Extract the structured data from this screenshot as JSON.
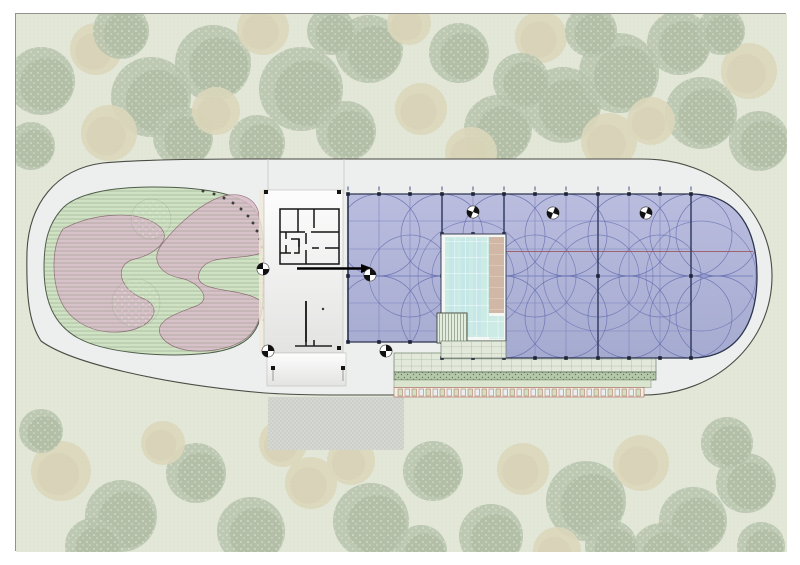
{
  "meta": {
    "kind": "architectural-site-plan",
    "title": ""
  },
  "canvas": {
    "w": 800,
    "h": 565,
    "frame": {
      "x": 15,
      "y": 13,
      "w": 771,
      "h": 538,
      "bg": "#e2e7d8",
      "border": "#92928c"
    }
  },
  "palette": {
    "grass": "#e2e7d8",
    "grass_dot": "#d6dcc7",
    "tree_green": "#8da081",
    "tree_green_dark": "#798e6d",
    "tree_leaf": "#eef2e2",
    "tree_tan": "#d6c8a0",
    "tree_tan_dark": "#cbbc92",
    "path_fill": "#ecefed",
    "path_stroke": "#4b4b45",
    "path_faint": "#c6c9c5",
    "garden_fill": "#cfe2c4",
    "garden_stroke": "#4f5c4a",
    "garden_hatch": "#4d6648",
    "pink_fill": "#dabfca",
    "pink_stroke": "#8d6573",
    "building_fill_top": "#fdfdfd",
    "building_fill_bot": "#e3e3e2",
    "building_stroke": "#c3c3be",
    "wall": "#141414",
    "cream_strip": "#f2ead9",
    "canopy_top": "#b7badd",
    "canopy_bot": "#a2a7cf",
    "canopy_edge": "#2c3550",
    "canopy_major": "#343e63",
    "canopy_minor": "#7d84bf",
    "canopy_circle": "#6069ad",
    "canopy_red": "#9b5560",
    "marker_dark": "#1d2438",
    "marker_tick": "#99a0b8",
    "pool_cut": "#f4f7f3",
    "pool_water": "#cdebe5",
    "pool_stripe": "#bfe3eb",
    "pool_grid": "#ffffff",
    "deck": "#d1b7a5",
    "deck_joint": "#e6d6c8",
    "steps_bg": "#e4ebdf",
    "steps_line": "#7f937b",
    "paver_bg": "#e2e9da",
    "paver_line": "#8a9d82",
    "hedge_bg": "#b5c9aa",
    "hedge_dot": "#5f7b57",
    "plain_band": "#d9e5cf",
    "plain_band_stroke": "#8a9a82",
    "plant_bg": "#eef0e4",
    "plant_stroke": "#b2675a",
    "plant_a": "#cfe0c4",
    "plant_b": "#e9eef2",
    "driveway_bg": "#d4d7d2",
    "driveway_line": "#c3c8c0",
    "symbol_dark": "#111111",
    "symbol_ring": "#444444"
  },
  "trees": {
    "layer_opacity": 0.5,
    "items": [
      [
        40,
        80,
        34,
        "g"
      ],
      [
        95,
        48,
        26,
        "t"
      ],
      [
        150,
        96,
        40,
        "g"
      ],
      [
        108,
        132,
        28,
        "t"
      ],
      [
        212,
        62,
        38,
        "g"
      ],
      [
        182,
        136,
        30,
        "g"
      ],
      [
        262,
        28,
        26,
        "t"
      ],
      [
        300,
        88,
        42,
        "g"
      ],
      [
        256,
        142,
        28,
        "g"
      ],
      [
        368,
        48,
        34,
        "g"
      ],
      [
        345,
        130,
        30,
        "g"
      ],
      [
        420,
        108,
        26,
        "t"
      ],
      [
        458,
        52,
        30,
        "g"
      ],
      [
        497,
        128,
        34,
        "g"
      ],
      [
        540,
        36,
        26,
        "t"
      ],
      [
        562,
        104,
        38,
        "g"
      ],
      [
        618,
        72,
        40,
        "g"
      ],
      [
        608,
        140,
        28,
        "t"
      ],
      [
        678,
        42,
        32,
        "g"
      ],
      [
        700,
        112,
        36,
        "g"
      ],
      [
        748,
        70,
        28,
        "t"
      ],
      [
        758,
        140,
        30,
        "g"
      ],
      [
        30,
        145,
        24,
        "g"
      ],
      [
        408,
        22,
        22,
        "t"
      ],
      [
        470,
        152,
        26,
        "t"
      ],
      [
        650,
        120,
        24,
        "t"
      ],
      [
        215,
        110,
        24,
        "t"
      ],
      [
        520,
        80,
        28,
        "g"
      ],
      [
        120,
        30,
        28,
        "g"
      ],
      [
        330,
        30,
        24,
        "g"
      ],
      [
        590,
        30,
        26,
        "g"
      ],
      [
        720,
        30,
        24,
        "g"
      ],
      [
        60,
        470,
        30,
        "t"
      ],
      [
        120,
        515,
        36,
        "g"
      ],
      [
        195,
        472,
        30,
        "g"
      ],
      [
        250,
        530,
        34,
        "g"
      ],
      [
        310,
        482,
        26,
        "t"
      ],
      [
        370,
        520,
        38,
        "g"
      ],
      [
        432,
        470,
        30,
        "g"
      ],
      [
        490,
        535,
        32,
        "g"
      ],
      [
        522,
        468,
        26,
        "t"
      ],
      [
        585,
        500,
        40,
        "g"
      ],
      [
        640,
        462,
        28,
        "t"
      ],
      [
        692,
        520,
        34,
        "g"
      ],
      [
        745,
        482,
        30,
        "g"
      ],
      [
        92,
        545,
        28,
        "g"
      ],
      [
        420,
        550,
        26,
        "g"
      ],
      [
        660,
        552,
        30,
        "g"
      ],
      [
        282,
        442,
        24,
        "t"
      ],
      [
        726,
        442,
        26,
        "g"
      ],
      [
        162,
        442,
        22,
        "t"
      ],
      [
        556,
        550,
        24,
        "t"
      ],
      [
        40,
        430,
        22,
        "g"
      ],
      [
        350,
        460,
        24,
        "t"
      ],
      [
        610,
        545,
        26,
        "g"
      ],
      [
        760,
        545,
        24,
        "g"
      ]
    ]
  },
  "site": {
    "outer_path": "M102,162 C54,168 28,204 26,250 C25,296 28,322 40,340 C70,362 160,383 264,392 C294,394 310,394 330,394 L642,394 C716,394 771,341 771,275 C771,209 716,158 642,158 L248,158 C188,158 134,159 102,162 Z",
    "entry_lines": [
      [
        267,
        158,
        267,
        190
      ],
      [
        343,
        158,
        343,
        193
      ]
    ]
  },
  "garden": {
    "path": "M60,209 C74,192 112,186 152,186 C202,186 244,192 256,212 C264,226 263,260 262,298 C261,330 248,347 208,352 C163,357 104,352 77,337 C52,323 43,299 43,267 C43,239 48,223 60,209 Z",
    "pink_paths": [
      "M62,228 C92,212 132,210 152,221 C176,234 158,252 134,258 C112,263 118,288 141,297 C166,307 149,329 119,331 C89,333 67,318 59,298 C51,278 50,246 62,228 Z",
      "M228,194 C244,192 256,200 258,214 C260,232 260,242 260,252 C238,260 208,252 199,270 C189,290 228,287 250,295 C258,298 260,300 260,303 C260,322 252,340 224,347 C194,354 169,349 160,335 C151,319 180,311 195,305 C212,299 199,281 179,277 C159,273 149,259 161,243 C175,225 204,197 228,194 Z"
    ],
    "inner_trees": [
      [
        150,
        218,
        20
      ],
      [
        135,
        302,
        24
      ]
    ],
    "edge_ticks": [
      [
        202,
        190
      ],
      [
        213,
        193
      ],
      [
        223,
        197
      ],
      [
        232,
        202
      ],
      [
        240,
        208
      ],
      [
        247,
        215
      ],
      [
        252,
        222
      ],
      [
        256,
        230
      ],
      [
        259,
        238
      ],
      [
        261,
        246
      ],
      [
        263,
        258
      ],
      [
        263,
        270
      ],
      [
        263,
        282
      ],
      [
        263,
        294
      ],
      [
        263,
        307
      ],
      [
        263,
        319
      ]
    ]
  },
  "building": {
    "base": [
      263,
      189,
      79,
      163
    ],
    "stub": [
      266,
      352,
      79,
      33
    ],
    "cream_strip": [
      258,
      189,
      5,
      163
    ],
    "plan_walls": [
      "M279,208H338V263H279Z",
      "M297,208V231",
      "M313,208V227",
      "M279,231H304",
      "M310,231H338",
      "M285,231V238",
      "M285,244V252",
      "M279,252H290",
      "M290,238H298V252H293",
      "M298,238V246",
      "M305,232V243",
      "M305,249V263",
      "M311,247H318",
      "M324,247H338"
    ],
    "arrow": {
      "x1": 296,
      "y": 267.5,
      "x2": 360,
      "head": 372
    },
    "wall_seg": [
      305,
      300,
      305,
      341
    ],
    "dot": [
      322,
      308
    ],
    "threshold": [
      "M294,345H331",
      "M305,339V345",
      "M313,339V345"
    ],
    "corner_markers": [
      [
        265,
        191
      ],
      [
        338,
        191
      ],
      [
        265,
        347
      ],
      [
        338,
        347
      ]
    ],
    "leg_markers": [
      [
        272,
        367
      ],
      [
        342,
        367
      ]
    ]
  },
  "canopy": {
    "path": "M347,193 H690 C738,193 756,230 756,275 C756,320 738,357 690,357 H441 V341 H347 Z",
    "minor_vx": [
      378,
      409,
      472,
      534,
      565,
      628,
      659
    ],
    "major_vx": [
      347,
      441,
      503,
      597,
      690
    ],
    "minor_hy": [
      220,
      248,
      302,
      330
    ],
    "mid_y": 275,
    "grid_x_range": [
      347,
      690
    ],
    "cap_x_end": 752,
    "red_line": {
      "x1": 505,
      "x2": 752,
      "y": 250.5
    },
    "circle_r": 41,
    "circle_rows": {
      "ys": [
        234,
        316
      ],
      "xs": [
        378,
        441,
        503,
        565,
        628,
        690,
        716
      ]
    },
    "circle_mid": {
      "y": 275,
      "xs": [
        409,
        472,
        534,
        597,
        659
      ]
    },
    "circle_big": {
      "r": 55,
      "centers": [
        [
          472,
          275
        ],
        [
          597,
          275
        ],
        [
          700,
          275
        ]
      ]
    },
    "top_markers": {
      "y": 193,
      "xs": [
        347,
        378,
        409,
        441,
        472,
        503,
        534,
        565,
        597,
        628,
        659,
        690
      ]
    },
    "bottom_markers": [
      [
        347,
        341
      ],
      [
        378,
        341
      ],
      [
        409,
        341
      ],
      [
        441,
        341
      ],
      [
        441,
        357
      ],
      [
        472,
        357
      ],
      [
        503,
        357
      ],
      [
        534,
        357
      ],
      [
        565,
        357
      ],
      [
        597,
        357
      ],
      [
        628,
        357
      ],
      [
        659,
        357
      ],
      [
        690,
        357
      ]
    ],
    "mid_markers": {
      "y": 275,
      "xs": [
        347,
        441,
        503,
        597,
        690
      ]
    },
    "pool_top_markers": {
      "y": 233,
      "xs": [
        441,
        472,
        503
      ]
    }
  },
  "pool": {
    "cut": [
      440,
      233,
      65,
      107
    ],
    "water": [
      444,
      236,
      44,
      100
    ],
    "stripes": [
      [
        448,
        238,
        8,
        96
      ],
      [
        460,
        238,
        8,
        96
      ],
      [
        472,
        238,
        8,
        96
      ]
    ],
    "deck": [
      488,
      236,
      15,
      76
    ],
    "small_water": [
      488,
      315,
      15,
      23
    ],
    "steps": [
      436,
      312,
      30,
      30
    ],
    "paver_patch": [
      440,
      340,
      65,
      17
    ]
  },
  "bands": {
    "paver": [
      393,
      352,
      262,
      19
    ],
    "hedge": [
      393,
      371,
      262,
      8
    ],
    "plain": [
      393,
      379,
      257,
      7.5
    ],
    "plants": {
      "x0": 397,
      "y": 387,
      "h": 9,
      "count": 35,
      "w": 4.5,
      "gap": 2.5,
      "bg": [
        393,
        386.5,
        250,
        9.5
      ]
    }
  },
  "driveway": [
    267,
    396,
    136,
    53
  ],
  "symbols": {
    "survey_markers": [
      [
        262,
        268,
        -90
      ],
      [
        369,
        274,
        0
      ],
      [
        267,
        350,
        180
      ],
      [
        385,
        350,
        0
      ],
      [
        472,
        211,
        20
      ],
      [
        552,
        212,
        20
      ],
      [
        645,
        212,
        20
      ]
    ]
  }
}
